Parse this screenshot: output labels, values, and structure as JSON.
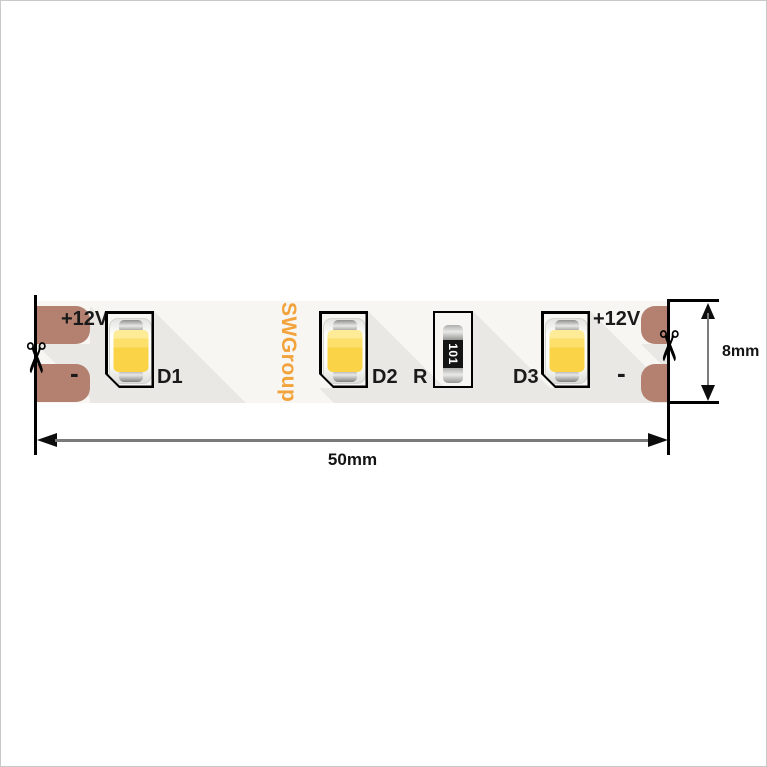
{
  "strip": {
    "brand": "SWGroup",
    "terminals": {
      "left": {
        "positive": "+12V",
        "negative": "-"
      },
      "right": {
        "positive": "+12V",
        "negative": "-"
      }
    },
    "components": {
      "led1_label": "D1",
      "led2_label": "D2",
      "led3_label": "D3",
      "resistor_label": "R",
      "resistor_code": "101"
    },
    "cut_icon_glyph": "✂"
  },
  "dimensions": {
    "length": "50mm",
    "height": "8mm"
  },
  "colors": {
    "copper_pad": "#b48171",
    "brand_orange": "#f2a33c",
    "led_yellow": "#fbd347",
    "strip_background": "#f7f6f3",
    "component_shadow": "#e9e8e4",
    "resistor_body": "#141414",
    "dimension_line": "#7b7b7b"
  }
}
